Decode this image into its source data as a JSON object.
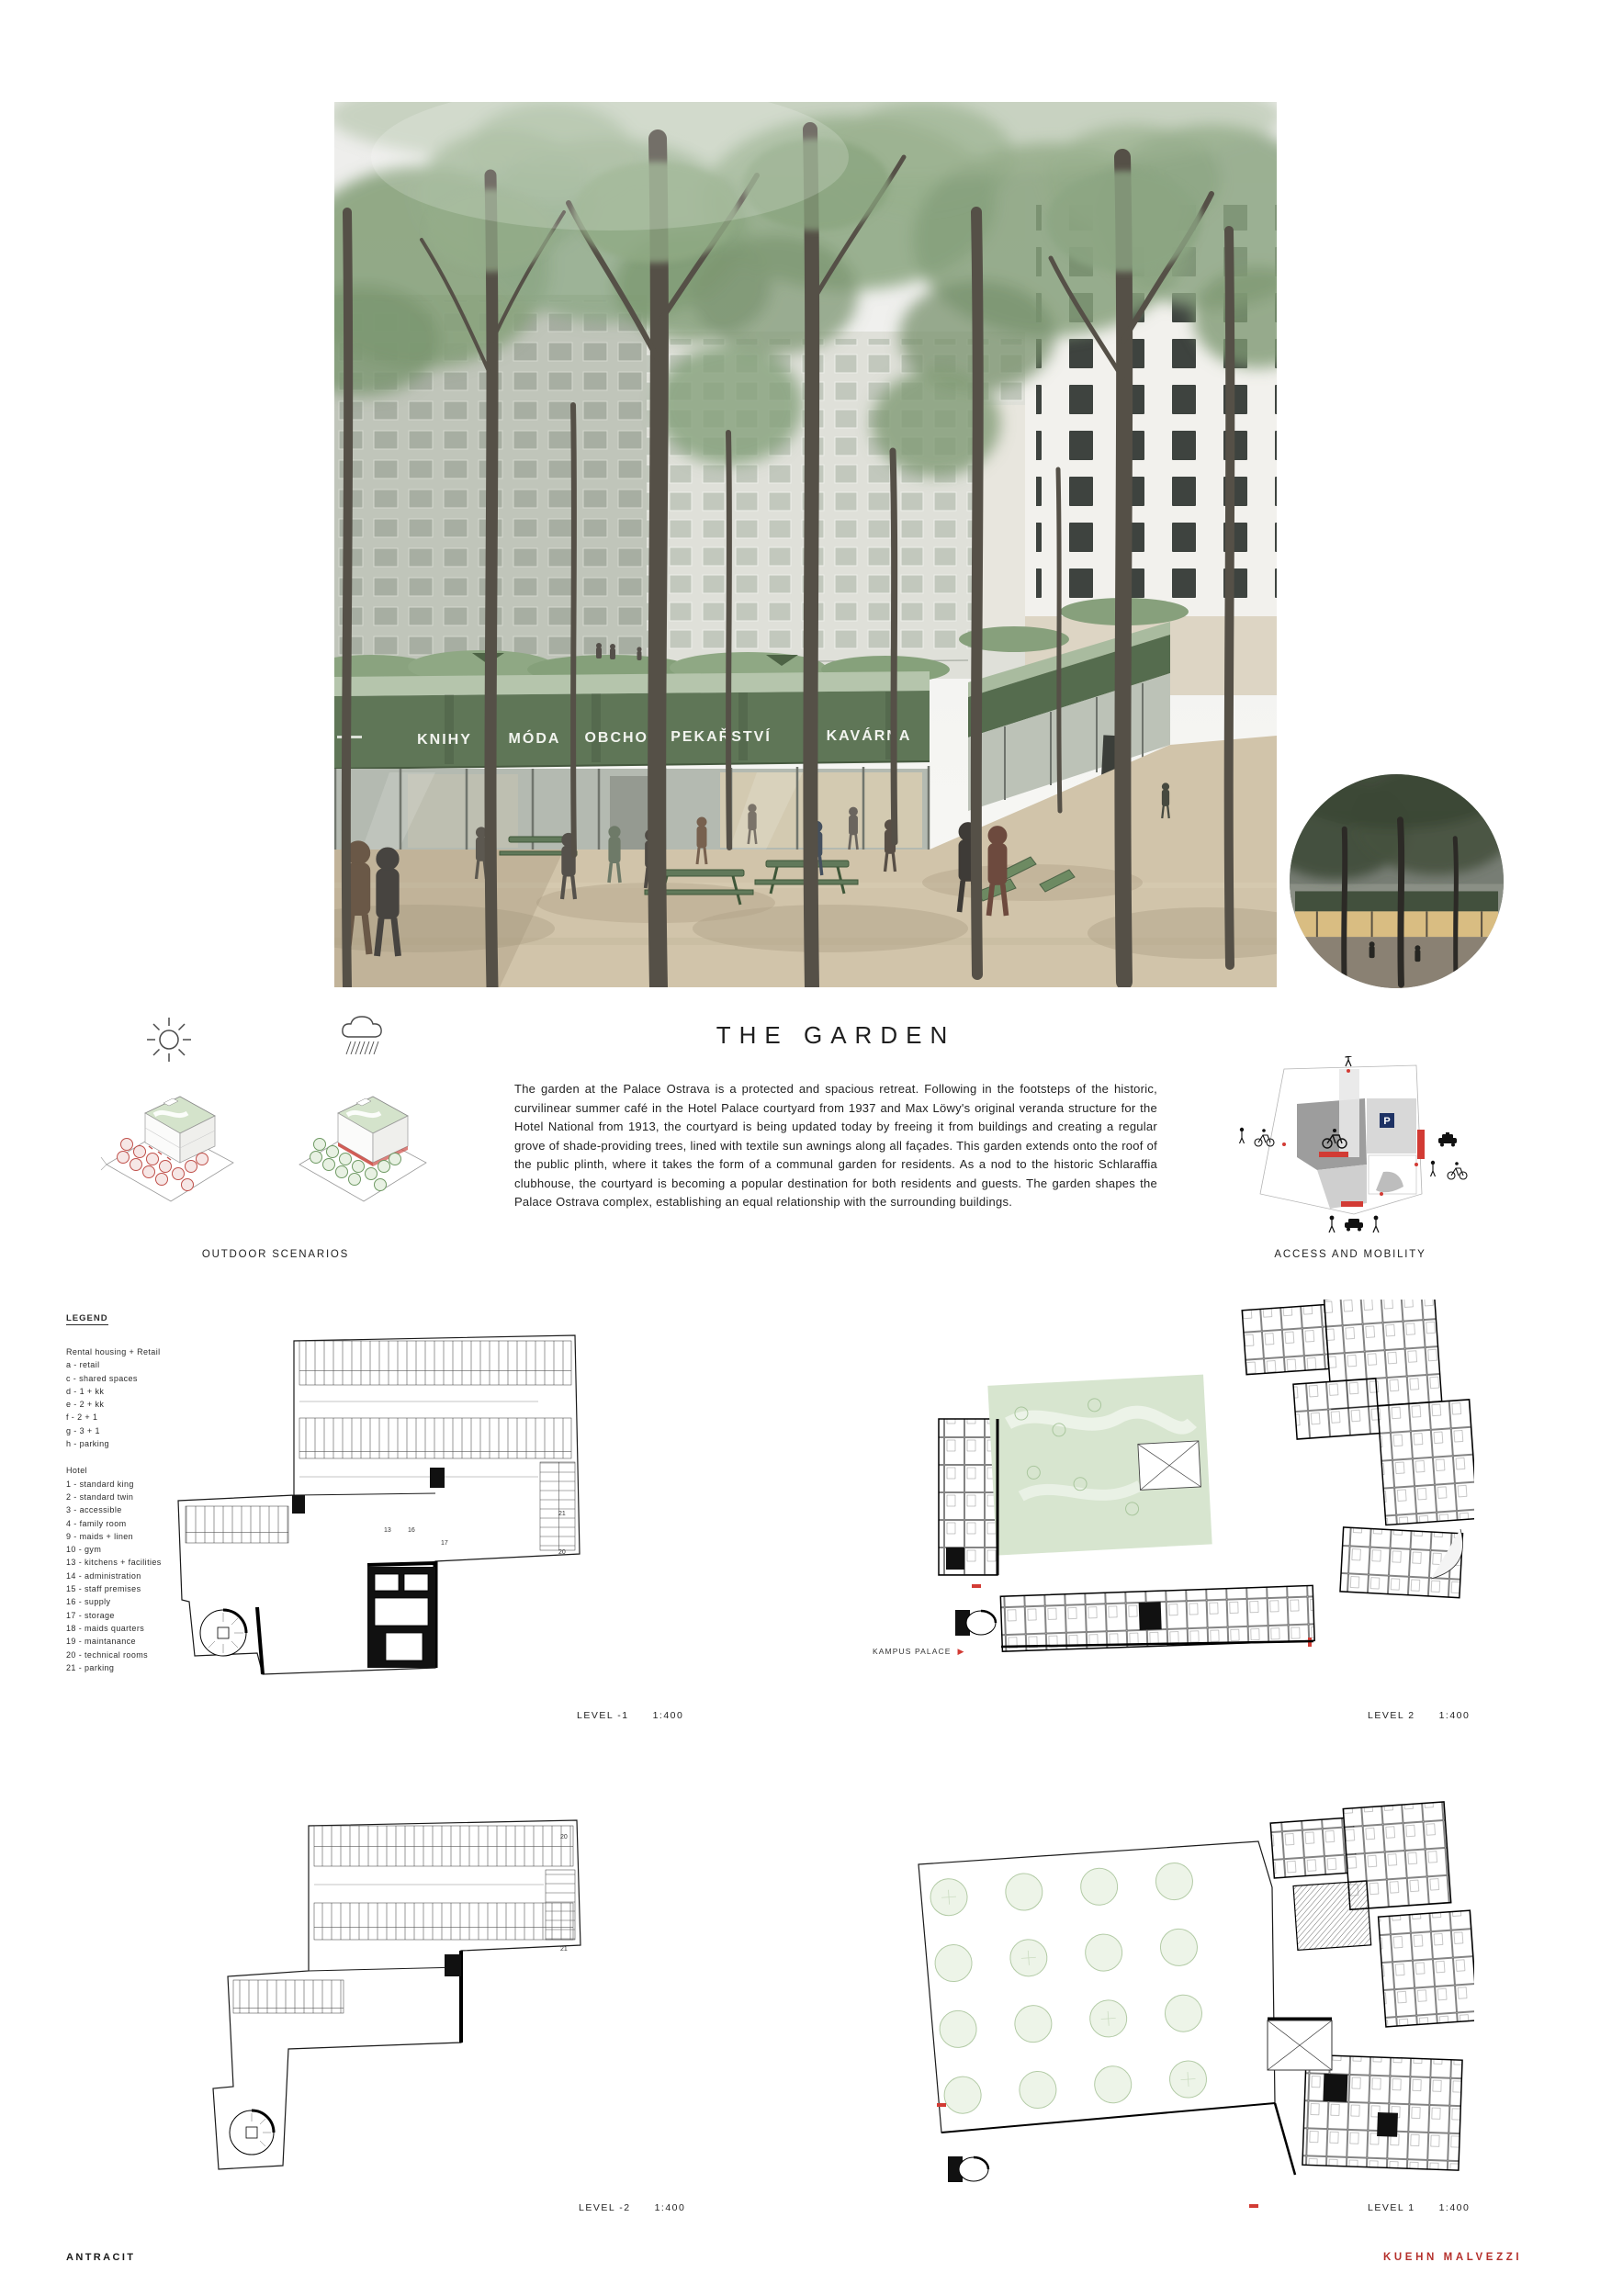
{
  "page": {
    "title": "THE GARDEN",
    "description": "The garden at the Palace Ostrava is a protected and spacious retreat. Following in the footsteps of the historic, curvilinear summer café in the Hotel Palace courtyard from 1937 and Max Löwy's original veranda structure for the Hotel National from 1913, the courtyard is being updated today by freeing it from buildings and creating a regular grove of shade-providing trees, lined with textile sun awnings along all façades. This garden extends onto the roof of the public plinth, where it takes the form of a communal garden for residents. As a nod to the historic Schlaraffia clubhouse, the courtyard is becoming a popular destination for both residents and guests. The garden shapes the Palace Ostrava complex, establishing an equal relationship with the surrounding buildings."
  },
  "rendering": {
    "awning_labels": [
      "KNIHY",
      "MÓDA",
      "OBCHOD",
      "PEKAŘSTVÍ",
      "KAVÁRNA"
    ]
  },
  "diagrams": {
    "outdoor_scenarios_label": "OUTDOOR SCENARIOS",
    "access_mobility_label": "ACCESS AND MOBILITY",
    "kampus_palace_label": "KAMPUS PALACE",
    "parking_sign": "P"
  },
  "legend": {
    "heading": "LEGEND",
    "rental_heading": "Rental housing + Retail",
    "rental_items": [
      "a - retail",
      "c - shared spaces",
      "d - 1 + kk",
      "e - 2 + kk",
      "f - 2 + 1",
      "g - 3 + 1",
      "h - parking"
    ],
    "hotel_heading": "Hotel",
    "hotel_items": [
      "1 - standard king",
      "2 - standard twin",
      "3 - accessible",
      "4 - family room",
      "9 - maids + linen",
      "10 - gym",
      "13 - kitchens + facilities",
      "14 - administration",
      "15 - staff premises",
      "16 - supply",
      "17 - storage",
      "18 - maids quarters",
      "19 - maintanance",
      "20 - technical rooms",
      "21 - parking"
    ]
  },
  "plans": [
    {
      "id": "level-minus-1",
      "label": "LEVEL -1",
      "scale": "1:400",
      "nums": [
        "13",
        "16",
        "17",
        "21",
        "20"
      ]
    },
    {
      "id": "level-2",
      "label": "LEVEL 2",
      "scale": "1:400"
    },
    {
      "id": "level-minus-2",
      "label": "LEVEL -2",
      "scale": "1:400",
      "nums": [
        "21",
        "20"
      ]
    },
    {
      "id": "level-1",
      "label": "LEVEL 1",
      "scale": "1:400"
    }
  ],
  "footer": {
    "left": "ANTRACIT",
    "right": "KUEHN MALVEZZI",
    "accent_color": "#b5302c"
  }
}
